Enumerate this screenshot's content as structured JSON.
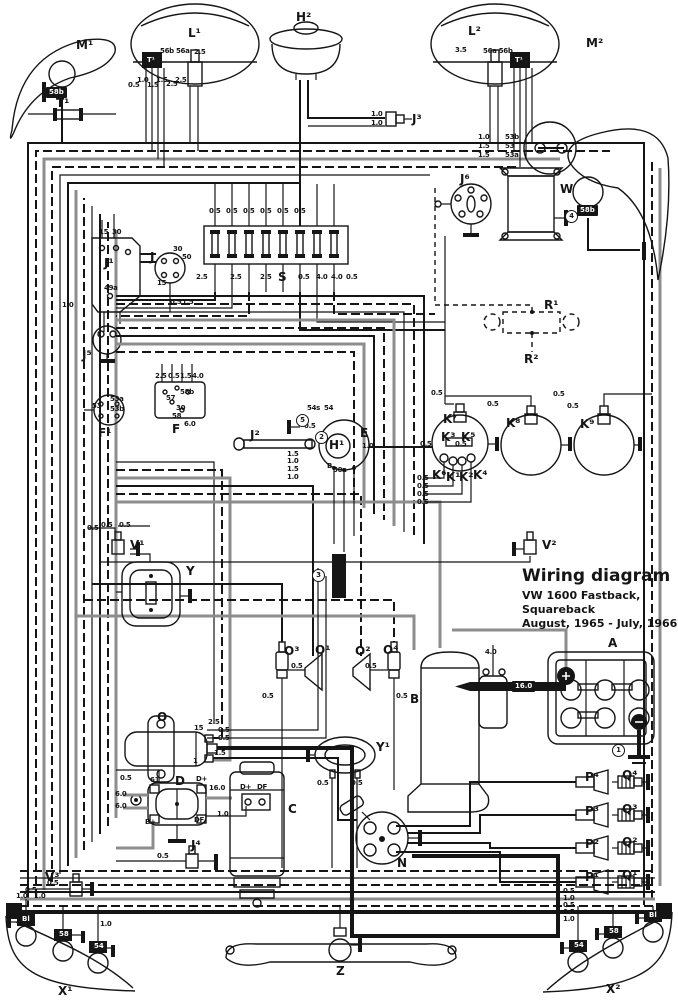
{
  "title_block": {
    "line1": "Wiring diagram",
    "line2": "VW 1600 Fastback, Squareback",
    "line3": "August, 1965 - July, 1966"
  },
  "colors": {
    "wire": "#151515",
    "wire_gray": "#8d8d8d",
    "background": "#ffffff"
  },
  "component_labels": [
    {
      "text": "M¹",
      "x": 76,
      "y": 38
    },
    {
      "text": "L¹",
      "x": 188,
      "y": 26
    },
    {
      "text": "H²",
      "x": 296,
      "y": 10
    },
    {
      "text": "L²",
      "x": 468,
      "y": 24
    },
    {
      "text": "M²",
      "x": 586,
      "y": 36
    },
    {
      "text": "T¹",
      "x": 56,
      "y": 96
    },
    {
      "text": "J³",
      "x": 412,
      "y": 112
    },
    {
      "text": "W",
      "x": 560,
      "y": 182
    },
    {
      "text": "J⁶",
      "x": 460,
      "y": 172
    },
    {
      "text": "J¹",
      "x": 104,
      "y": 256
    },
    {
      "text": "J",
      "x": 150,
      "y": 250
    },
    {
      "text": "S",
      "x": 278,
      "y": 270
    },
    {
      "text": "R¹",
      "x": 544,
      "y": 298
    },
    {
      "text": "R²",
      "x": 524,
      "y": 352
    },
    {
      "text": "J⁵",
      "x": 82,
      "y": 348
    },
    {
      "text": "F¹",
      "x": 98,
      "y": 426
    },
    {
      "text": "F",
      "x": 172,
      "y": 422
    },
    {
      "text": "J²",
      "x": 250,
      "y": 428
    },
    {
      "text": "E",
      "x": 360,
      "y": 426
    },
    {
      "text": "H¹",
      "x": 329,
      "y": 438
    },
    {
      "text": "K⁷",
      "x": 443,
      "y": 412
    },
    {
      "text": "K³",
      "x": 441,
      "y": 430
    },
    {
      "text": "K⁵",
      "x": 461,
      "y": 430
    },
    {
      "text": "K⁶",
      "x": 432,
      "y": 468
    },
    {
      "text": "K¹",
      "x": 446,
      "y": 470
    },
    {
      "text": "K²",
      "x": 459,
      "y": 470
    },
    {
      "text": "K⁴",
      "x": 473,
      "y": 468
    },
    {
      "text": "K⁸",
      "x": 506,
      "y": 416
    },
    {
      "text": "K⁹",
      "x": 580,
      "y": 417
    },
    {
      "text": "V¹",
      "x": 130,
      "y": 538
    },
    {
      "text": "V²",
      "x": 542,
      "y": 538
    },
    {
      "text": "Y",
      "x": 186,
      "y": 564
    },
    {
      "text": "Y¹",
      "x": 376,
      "y": 740
    },
    {
      "text": "O³",
      "x": 284,
      "y": 644
    },
    {
      "text": "O¹",
      "x": 315,
      "y": 643
    },
    {
      "text": "O²",
      "x": 355,
      "y": 644
    },
    {
      "text": "O⁴",
      "x": 383,
      "y": 643
    },
    {
      "text": "A",
      "x": 608,
      "y": 636
    },
    {
      "text": "B",
      "x": 410,
      "y": 692
    },
    {
      "text": "O",
      "x": 157,
      "y": 710
    },
    {
      "text": "D",
      "x": 175,
      "y": 774
    },
    {
      "text": "C",
      "x": 288,
      "y": 802
    },
    {
      "text": "N",
      "x": 397,
      "y": 856
    },
    {
      "text": "J⁴",
      "x": 191,
      "y": 838
    },
    {
      "text": "V³",
      "x": 45,
      "y": 870
    },
    {
      "text": "P⁴",
      "x": 585,
      "y": 770
    },
    {
      "text": "Q⁴",
      "x": 622,
      "y": 768
    },
    {
      "text": "P³",
      "x": 585,
      "y": 804
    },
    {
      "text": "Q³",
      "x": 622,
      "y": 802
    },
    {
      "text": "P²",
      "x": 585,
      "y": 837
    },
    {
      "text": "Q²",
      "x": 622,
      "y": 835
    },
    {
      "text": "P¹",
      "x": 585,
      "y": 870
    },
    {
      "text": "Q¹",
      "x": 622,
      "y": 868
    },
    {
      "text": "X¹",
      "x": 58,
      "y": 984
    },
    {
      "text": "X²",
      "x": 606,
      "y": 982
    },
    {
      "text": "Z",
      "x": 336,
      "y": 964
    }
  ],
  "small_labels": [
    {
      "text": "56b 56a",
      "x": 160,
      "y": 47
    },
    {
      "text": "2.5",
      "x": 194,
      "y": 48
    },
    {
      "text": "3.5",
      "x": 455,
      "y": 46
    },
    {
      "text": "56a 56b",
      "x": 483,
      "y": 47
    },
    {
      "text": "0.5",
      "x": 128,
      "y": 81
    },
    {
      "text": "1.0",
      "x": 137,
      "y": 76
    },
    {
      "text": "1.5",
      "x": 147,
      "y": 81
    },
    {
      "text": "1.5",
      "x": 156,
      "y": 76
    },
    {
      "text": "2.5",
      "x": 166,
      "y": 80
    },
    {
      "text": "2.5",
      "x": 175,
      "y": 76
    },
    {
      "text": "1.0",
      "x": 371,
      "y": 110
    },
    {
      "text": "1.0",
      "x": 371,
      "y": 119
    },
    {
      "text": "1.0",
      "x": 478,
      "y": 133
    },
    {
      "text": "53b",
      "x": 505,
      "y": 133
    },
    {
      "text": "1.5",
      "x": 478,
      "y": 142
    },
    {
      "text": "53",
      "x": 505,
      "y": 142
    },
    {
      "text": "1.5",
      "x": 478,
      "y": 151
    },
    {
      "text": "53a",
      "x": 505,
      "y": 151
    },
    {
      "text": "15",
      "x": 99,
      "y": 228
    },
    {
      "text": "30",
      "x": 112,
      "y": 228
    },
    {
      "text": "49a",
      "x": 104,
      "y": 284
    },
    {
      "text": "30",
      "x": 173,
      "y": 245
    },
    {
      "text": "50",
      "x": 182,
      "y": 253
    },
    {
      "text": "15",
      "x": 157,
      "y": 279
    },
    {
      "text": "0.5",
      "x": 209,
      "y": 207
    },
    {
      "text": "0.5",
      "x": 226,
      "y": 207
    },
    {
      "text": "0.5",
      "x": 243,
      "y": 207
    },
    {
      "text": "0.5",
      "x": 260,
      "y": 207
    },
    {
      "text": "0.5",
      "x": 277,
      "y": 207
    },
    {
      "text": "0.5",
      "x": 294,
      "y": 207
    },
    {
      "text": "2.5",
      "x": 196,
      "y": 273
    },
    {
      "text": "2.5",
      "x": 230,
      "y": 273
    },
    {
      "text": "2.5",
      "x": 260,
      "y": 273
    },
    {
      "text": "0.5",
      "x": 298,
      "y": 273
    },
    {
      "text": "4.0",
      "x": 316,
      "y": 273
    },
    {
      "text": "4.0",
      "x": 331,
      "y": 273
    },
    {
      "text": "0.5",
      "x": 346,
      "y": 273
    },
    {
      "text": "1.0",
      "x": 62,
      "y": 301
    },
    {
      "text": "0.5",
      "x": 170,
      "y": 298
    },
    {
      "text": "1.5",
      "x": 182,
      "y": 298
    },
    {
      "text": "2.5",
      "x": 155,
      "y": 372
    },
    {
      "text": "0.5",
      "x": 168,
      "y": 372
    },
    {
      "text": "1.5",
      "x": 180,
      "y": 372
    },
    {
      "text": "4.0",
      "x": 192,
      "y": 372
    },
    {
      "text": "57",
      "x": 166,
      "y": 394
    },
    {
      "text": "58b",
      "x": 180,
      "y": 388
    },
    {
      "text": "30",
      "x": 176,
      "y": 404
    },
    {
      "text": "58",
      "x": 172,
      "y": 412
    },
    {
      "text": "6.0",
      "x": 184,
      "y": 420
    },
    {
      "text": "53a",
      "x": 110,
      "y": 395
    },
    {
      "text": "53",
      "x": 92,
      "y": 402
    },
    {
      "text": "53b",
      "x": 110,
      "y": 405
    },
    {
      "text": "54s",
      "x": 307,
      "y": 404
    },
    {
      "text": "54",
      "x": 324,
      "y": 404
    },
    {
      "text": "0.5",
      "x": 304,
      "y": 422
    },
    {
      "text": "B",
      "x": 327,
      "y": 462
    },
    {
      "text": "50a",
      "x": 333,
      "y": 466
    },
    {
      "text": "1.0",
      "x": 362,
      "y": 442
    },
    {
      "text": "1.5",
      "x": 287,
      "y": 450
    },
    {
      "text": "1.0",
      "x": 287,
      "y": 457
    },
    {
      "text": "1.5",
      "x": 287,
      "y": 465
    },
    {
      "text": "1.0",
      "x": 287,
      "y": 473
    },
    {
      "text": "0.5",
      "x": 420,
      "y": 440
    },
    {
      "text": "0.5",
      "x": 455,
      "y": 440
    },
    {
      "text": "0.5",
      "x": 417,
      "y": 474
    },
    {
      "text": "0.5",
      "x": 417,
      "y": 482
    },
    {
      "text": "0.5",
      "x": 417,
      "y": 490
    },
    {
      "text": "0.5",
      "x": 417,
      "y": 498
    },
    {
      "text": "0.5",
      "x": 431,
      "y": 389
    },
    {
      "text": "0.5",
      "x": 487,
      "y": 400
    },
    {
      "text": "0.5",
      "x": 553,
      "y": 390
    },
    {
      "text": "0.5",
      "x": 567,
      "y": 402
    },
    {
      "text": "0.5",
      "x": 87,
      "y": 524
    },
    {
      "text": "0.5",
      "x": 101,
      "y": 521
    },
    {
      "text": "0.5",
      "x": 119,
      "y": 521
    },
    {
      "text": "0.5",
      "x": 291,
      "y": 662
    },
    {
      "text": "0.5",
      "x": 365,
      "y": 662
    },
    {
      "text": "0.5",
      "x": 262,
      "y": 692
    },
    {
      "text": "0.5",
      "x": 396,
      "y": 692
    },
    {
      "text": "4.0",
      "x": 485,
      "y": 648
    },
    {
      "text": "2.5",
      "x": 208,
      "y": 718
    },
    {
      "text": "0.5",
      "x": 218,
      "y": 726
    },
    {
      "text": "0.5",
      "x": 218,
      "y": 734
    },
    {
      "text": "1.5",
      "x": 214,
      "y": 749
    },
    {
      "text": "15",
      "x": 194,
      "y": 724
    },
    {
      "text": "1",
      "x": 193,
      "y": 757
    },
    {
      "text": "61",
      "x": 150,
      "y": 776
    },
    {
      "text": "D+",
      "x": 196,
      "y": 775
    },
    {
      "text": "B+",
      "x": 145,
      "y": 818
    },
    {
      "text": "DF",
      "x": 194,
      "y": 816
    },
    {
      "text": "0.5",
      "x": 120,
      "y": 774
    },
    {
      "text": "6.0",
      "x": 115,
      "y": 790
    },
    {
      "text": "6.0",
      "x": 115,
      "y": 802
    },
    {
      "text": "16.0",
      "x": 209,
      "y": 784
    },
    {
      "text": "1.0",
      "x": 217,
      "y": 810
    },
    {
      "text": "D+",
      "x": 240,
      "y": 783
    },
    {
      "text": "DF",
      "x": 257,
      "y": 783
    },
    {
      "text": "0.5",
      "x": 157,
      "y": 852
    },
    {
      "text": "0.5",
      "x": 317,
      "y": 779
    },
    {
      "text": "0.5",
      "x": 351,
      "y": 779
    },
    {
      "text": "0.5",
      "x": 47,
      "y": 879
    },
    {
      "text": "1.0",
      "x": 16,
      "y": 892
    },
    {
      "text": "0.5",
      "x": 25,
      "y": 886
    },
    {
      "text": "1.0",
      "x": 34,
      "y": 892
    },
    {
      "text": "1.0",
      "x": 100,
      "y": 920
    },
    {
      "text": "0.5",
      "x": 563,
      "y": 887
    },
    {
      "text": "1.0",
      "x": 563,
      "y": 894
    },
    {
      "text": "0.5",
      "x": 563,
      "y": 901
    },
    {
      "text": "0.5",
      "x": 563,
      "y": 908
    },
    {
      "text": "1.0",
      "x": 563,
      "y": 915
    }
  ],
  "socket_labels": [
    {
      "text": "T¹",
      "x": 144,
      "y": 55
    },
    {
      "text": "T¹",
      "x": 512,
      "y": 55
    },
    {
      "text": "58b",
      "x": 46,
      "y": 87
    },
    {
      "text": "58b",
      "x": 577,
      "y": 205
    },
    {
      "text": "Bl",
      "x": 19,
      "y": 914
    },
    {
      "text": "58",
      "x": 56,
      "y": 929
    },
    {
      "text": "54",
      "x": 91,
      "y": 941
    },
    {
      "text": "54",
      "x": 571,
      "y": 940
    },
    {
      "text": "58",
      "x": 606,
      "y": 926
    },
    {
      "text": "Bl",
      "x": 646,
      "y": 910
    },
    {
      "text": "16.0",
      "x": 512,
      "y": 681
    }
  ],
  "circled_markers": [
    {
      "text": "1",
      "x": 612,
      "y": 744
    },
    {
      "text": "2",
      "x": 315,
      "y": 431
    },
    {
      "text": "3",
      "x": 312,
      "y": 569
    },
    {
      "text": "4",
      "x": 565,
      "y": 210
    },
    {
      "text": "5",
      "x": 296,
      "y": 414
    }
  ]
}
